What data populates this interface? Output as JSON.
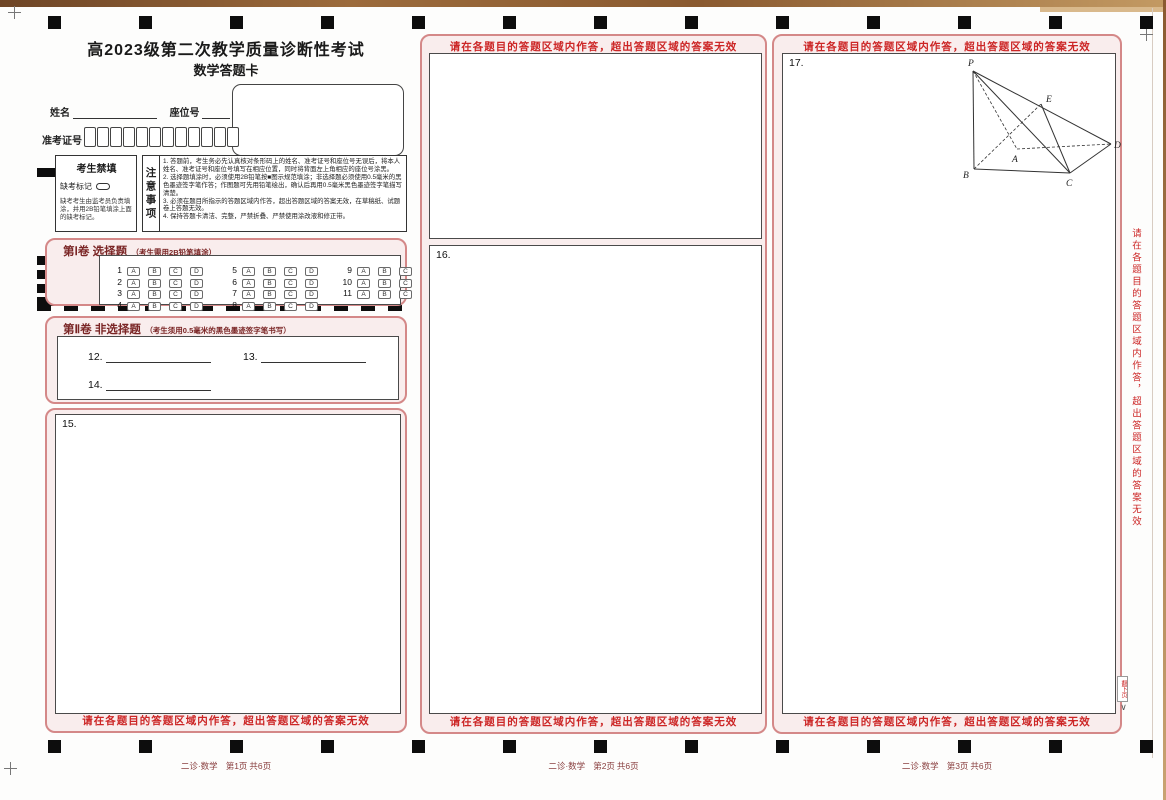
{
  "colors": {
    "accent_pink": "#d48888",
    "panel_pink": "#f9eded",
    "warning_red": "#cc2626",
    "section_maroon": "#7a2525",
    "footer_red": "#8a4040",
    "ink": "#222222"
  },
  "header": {
    "title": "高2023级第二次教学质量诊断性考试",
    "subtitle": "数学答题卡"
  },
  "fields": {
    "name_label": "姓名",
    "seat_label": "座位号",
    "exam_no_label": "准考证号",
    "exam_no_count": 12
  },
  "forbidden": {
    "title": "考生禁填",
    "absent_label": "缺考标记",
    "note": "缺考考生由监考员负责填涂，并用2B铅笔填涂上面的缺考标记。"
  },
  "notice": {
    "title": "注意事项",
    "items": [
      "1. 答题前，考生务必先认真核对条形码上的姓名、准考证号和座位号无误后，将本人姓名、准考证号和座位号填写在相应位置，同时将背面左上角相应的座位号涂黑。",
      "2. 选择题填涂时，必须使用2B铅笔按■图示规范填涂；非选择题必须使用0.5毫米的黑色墨迹签字笔作答；作图题可先用铅笔绘出，确认后再用0.5毫米黑色墨迹签字笔描写清楚。",
      "3. 必须在题目所指示的答题区域内作答，超出答题区域的答案无效，在草稿纸、试题卷上答题无效。",
      "4. 保持答题卡清洁、完整，严禁折叠、严禁使用涂改液和修正带。"
    ]
  },
  "section1": {
    "title": "第Ⅰ卷 选择题",
    "hint": "（考生需用2B铅笔填涂）",
    "options": [
      "A",
      "B",
      "C",
      "D"
    ],
    "columns": [
      [
        1,
        2,
        3,
        4
      ],
      [
        5,
        6,
        7,
        8
      ],
      [
        9,
        10,
        11
      ]
    ]
  },
  "section2": {
    "title": "第Ⅱ卷 非选择题",
    "hint": "（考生须用0.5毫米的黑色墨迹签字笔书写）",
    "blanks": [
      "12.",
      "13.",
      "14."
    ]
  },
  "questions": {
    "q15": "15.",
    "q16": "16.",
    "q17": "17."
  },
  "warning": "请在各题目的答题区域内作答，超出答题区域的答案无效",
  "side_note": "请在各题目的答题区域内作答，超出答题区域的答案无效",
  "next_page_tab": "翻下页",
  "figure": {
    "labels": {
      "P": "P",
      "E": "E",
      "D": "D",
      "A": "A",
      "B": "B",
      "C": "C"
    }
  },
  "footers": [
    {
      "brand": "二诊·数学",
      "page": "第1页",
      "total": "共6页"
    },
    {
      "brand": "二诊·数学",
      "page": "第2页",
      "total": "共6页"
    },
    {
      "brand": "二诊·数学",
      "page": "第3页",
      "total": "共6页"
    }
  ]
}
